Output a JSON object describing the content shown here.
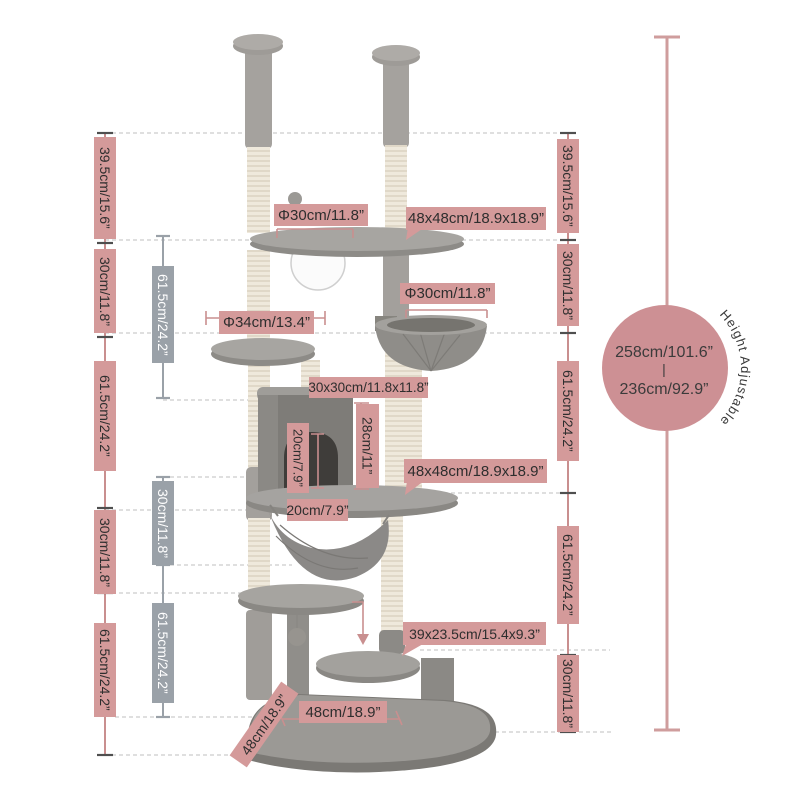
{
  "colors": {
    "label-pink": "#d49a9a",
    "label-gray": "#9aa1a8",
    "badge-pink": "#cd9094",
    "line-pink": "#c98f8f",
    "ruler-pink": "#cf9d9d",
    "line-gray": "#9aa1a8",
    "tick-dark": "#4f4f4f",
    "dashed-gray": "#cccccc",
    "text-dark": "#2e2e2e",
    "text-light": "#ffffff"
  },
  "left_outer_chain": {
    "items": [
      "39.5cm/15.6”",
      "30cm/11.8”",
      "61.5cm/24.2”",
      "30cm/11.8”",
      "61.5cm/24.2”"
    ]
  },
  "left_inner_chain": {
    "items": [
      "61.5cm/24.2”",
      "30cm/11.8”",
      "61.5cm/24.2”"
    ]
  },
  "right_chain": {
    "items": [
      "39.5cm/15.6”",
      "30cm/11.8”",
      "61.5cm/24.2”",
      "61.5cm/24.2”",
      "30cm/11.8”"
    ]
  },
  "part_labels": {
    "top_platform_dia": "Φ30cm/11.8”",
    "top_frame": "48x48cm/18.9x18.9”",
    "mid_platform_dia": "Φ34cm/13.4”",
    "basket_dia": "Φ30cm/11.8”",
    "house_top": "30x30cm/11.8x11.8”",
    "house_height": "28cm/11”",
    "door_height": "20cm/7.9”",
    "house_depth": "20cm/7.9”",
    "mid_frame": "48x48cm/18.9x18.9”",
    "step": "39x23.5cm/15.4x9.3”",
    "base_width": "48cm/18.9”",
    "base_depth": "48cm/18.9”"
  },
  "height_badge": {
    "max": "258cm/101.6”",
    "separator": "|",
    "min": "236cm/92.9”",
    "note": "Height Adjustable"
  }
}
